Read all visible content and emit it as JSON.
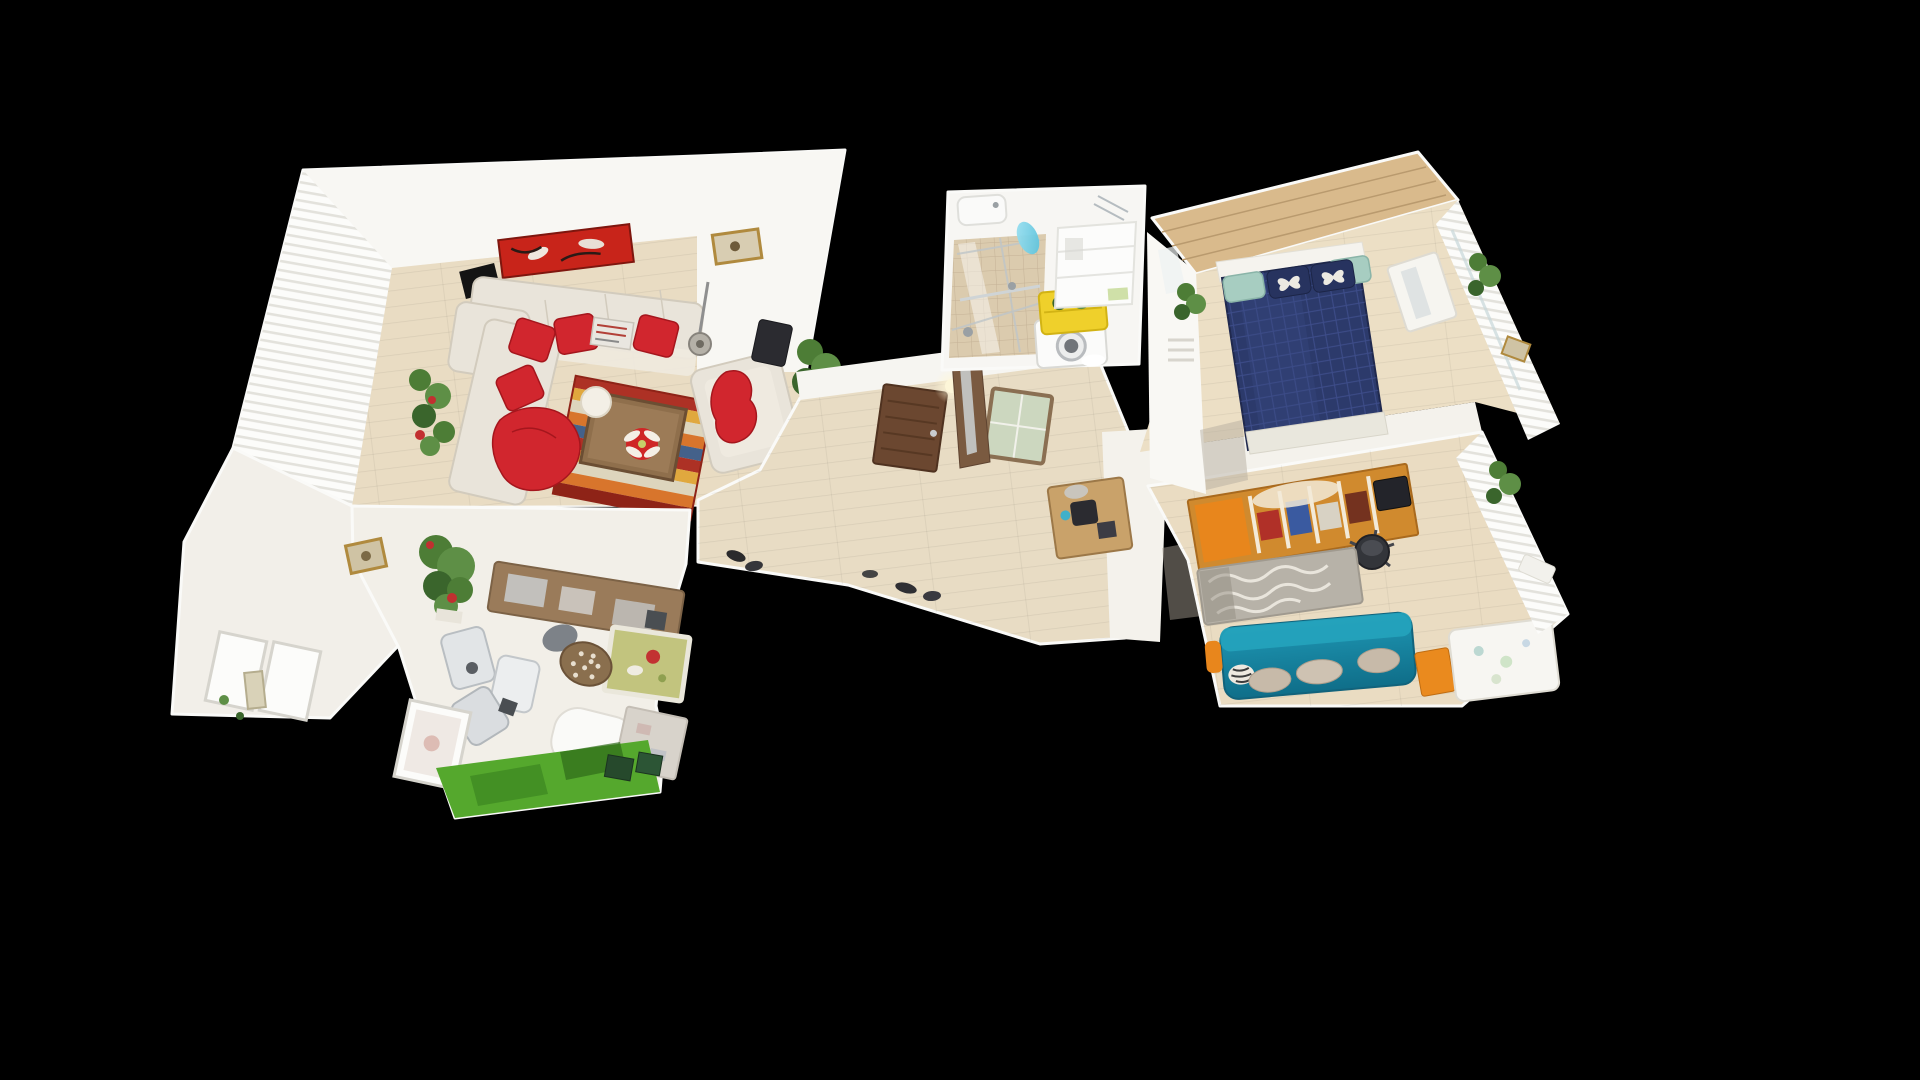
{
  "scene": {
    "description": "3D dollhouse top-down view of a scanned residential apartment floor plan on a black viewport background",
    "view_mode": "dollhouse-top-down",
    "visible_text": "none"
  },
  "rooms": [
    {
      "id": "living-room",
      "label": "Living room with cream sectional sofa, red throw pillows, red abstract wall art, striped oriental rug and window wall"
    },
    {
      "id": "dining-kitchen",
      "label": "Dining and kitchen area with plant, wooden sideboard, chairs, olive side table and green floor mat"
    },
    {
      "id": "hallway",
      "label": "Hallway with wooden doors, dresser and ceiling light"
    },
    {
      "id": "bathroom",
      "label": "Bathroom with tiled shower, washing machine and yellow towel"
    },
    {
      "id": "master-bedroom",
      "label": "Master bedroom with navy quilted bed, butterfly pillows and wood headboard wall"
    },
    {
      "id": "second-bedroom",
      "label": "Second bedroom with orange shelving unit, gray wave rug, teal daybed and white crib"
    }
  ],
  "palette": {
    "background": "#000000",
    "wall_white": "#f2efe9",
    "wall_bright": "#f8f7f3",
    "curtain_white": "#fcfcfa",
    "curtain_shadow": "#e3e2dc",
    "wood_floor": "#e9dcc3",
    "hall_floor": "#e8dcc4",
    "sofa_cream": "#e9e4da",
    "pillow_red": "#d1262e",
    "painting_red": "#c8241a",
    "table_wood": "#8f6f4c",
    "door_brown": "#6b4730",
    "tile_beige": "#dbcbae",
    "towel_yellow": "#efd02b",
    "plant_green": "#4d7d36",
    "plant_green_dark": "#3a652c",
    "bed_navy": "#2c3a6b",
    "pillow_teal": "#a7cdc1",
    "couch_teal": "#1f97b4",
    "couch_teal_deep": "#0f6e89",
    "accent_orange": "#e8861c",
    "wardrobe_orange": "#d08a2e",
    "rug_gray": "#b7b2a8",
    "grass_green": "#55a82d",
    "dark_object": "#2b2b30",
    "frame_gold": "#b08a3e",
    "crib_white": "#f7f6f2",
    "olive_table": "#c2c47e",
    "rug_red": "#ad3125",
    "rug_orange": "#d8752c",
    "rug_gold": "#e0a83e",
    "rug_cream": "#ddd5bd",
    "rug_blue": "#44618a",
    "chair_dark": "#33353a",
    "glass_teal": "#57c0da",
    "mirror_gray": "#ccd2d4"
  }
}
